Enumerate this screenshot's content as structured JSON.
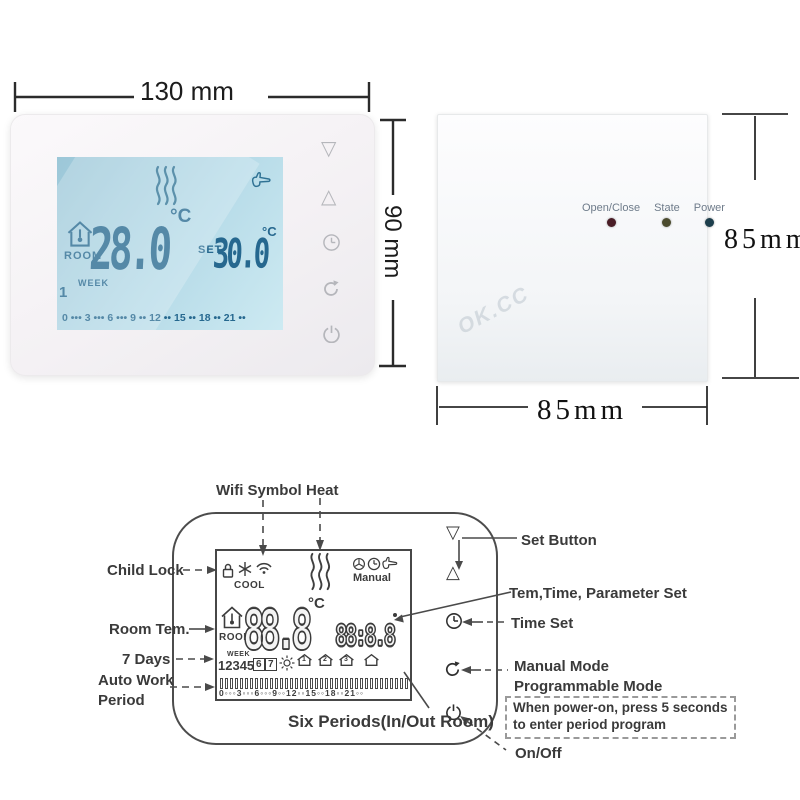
{
  "photo": {
    "dim_width": "130 mm",
    "dim_height": "90 mm",
    "screen": {
      "room_label": "ROOM",
      "room_temp": "28.0",
      "room_unit": "°C",
      "set_label": "SET",
      "set_temp": "30.0",
      "set_unit": "°C",
      "week_label": "WEEK",
      "week_day": "1",
      "timeline": "0 ••• 3 ••• 6 ••• 9 •• 12 •• 15 •• 18 •• 21 ••"
    }
  },
  "receiver": {
    "led_labels": [
      "Open/Close",
      "State",
      "Power"
    ],
    "led_colors": [
      "#4a1d26",
      "#4b4b2e",
      "#1d3e4c"
    ],
    "dim_height": "85mm",
    "dim_width": "85mm",
    "watermark": "OK.CC"
  },
  "diagram": {
    "labels": {
      "wifi_symbol": "Wifi Symbol",
      "heat": "Heat",
      "child_lock": "Child Lock",
      "room_tem": "Room Tem.",
      "seven_days": "7 Days",
      "auto_work_1": "Auto Work",
      "auto_work_2": "Period",
      "six_periods": "Six Periods(In/Out Room)",
      "set_button": "Set Button",
      "tem_time_param": "Tem,Time, Parameter Set",
      "time_set": "Time Set",
      "manual_mode": "Manual Mode",
      "programmable_mode": "Programmable Mode",
      "power_note_1": "When power-on, press 5 seconds",
      "power_note_2": "to enter period program",
      "on_off": "On/Off"
    },
    "screen": {
      "cool_label": "COOL",
      "manual_label": "Manual",
      "room_label": "ROOM",
      "temp_digits": "88.8",
      "temp_unit": "°C",
      "time_digits": "88:8.8",
      "week_label": "WEEK",
      "days": "12345",
      "day_box_1": "6",
      "day_box_2": "7",
      "period_digits": [
        "1",
        "2",
        "3"
      ],
      "timeline": "0◦◦◦3◦◦◦6◦◦◦9◦◦12◦◦15◦◦18◦◦21◦◦"
    }
  }
}
